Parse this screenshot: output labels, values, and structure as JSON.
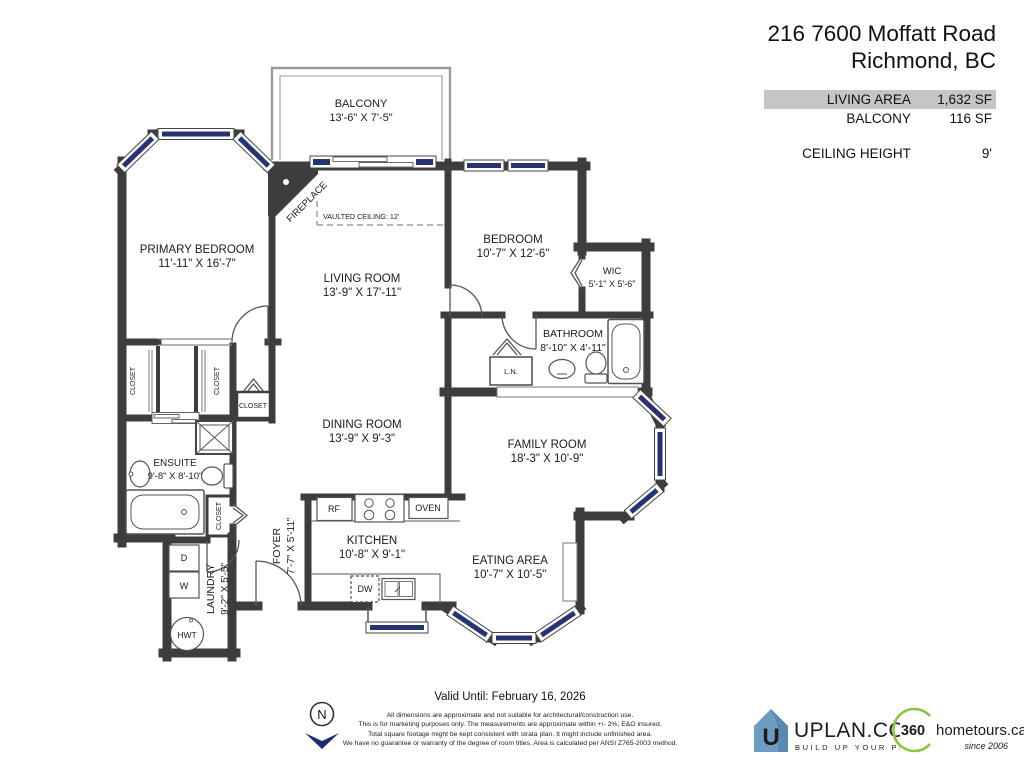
{
  "header": {
    "address_line1": "216 7600 Moffatt Road",
    "address_line2": "Richmond, BC",
    "stats": [
      {
        "label": "LIVING AREA",
        "value": "1,632 SF"
      },
      {
        "label": "BALCONY",
        "value": "116 SF"
      },
      {
        "label": "CEILING HEIGHT",
        "value": "9'"
      }
    ]
  },
  "plan": {
    "rooms": [
      {
        "name": "BALCONY",
        "dims": "13'-6\" X  7'-5\""
      },
      {
        "name": "PRIMARY BEDROOM",
        "dims": "11'-11\" X  16'-7\""
      },
      {
        "name": "LIVING ROOM",
        "dims": "13'-9\" X 17'-11\""
      },
      {
        "name": "BEDROOM",
        "dims": "10'-7\" X 12'-6\""
      },
      {
        "name": "WIC",
        "dims": "5'-1\" X 5'-6\""
      },
      {
        "name": "BATHROOM",
        "dims": "8'-10\" X 4'-11\""
      },
      {
        "name": "DINING ROOM",
        "dims": "13'-9\" X  9'-3\""
      },
      {
        "name": "FAMILY ROOM",
        "dims": "18'-3\" X 10'-9\""
      },
      {
        "name": "ENSUITE",
        "dims": "9'-8\" X 8'-10\""
      },
      {
        "name": "KITCHEN",
        "dims": "10'-8\" X  9'-1\""
      },
      {
        "name": "EATING AREA",
        "dims": "10'-7\" X 10'-5\""
      },
      {
        "name": "FOYER",
        "dims": "7'-7\" X 5'-11\""
      },
      {
        "name": "LAUNDRY",
        "dims": "9'-2\" X 5'-5\""
      }
    ],
    "labels": {
      "fireplace": "FIREPLACE",
      "vaulted": "VAULTED CEILING: 12'",
      "linen": "L.N.",
      "closet": "CLOSET"
    },
    "appliances": {
      "rf": "RF",
      "oven": "OVEN",
      "dw": "DW",
      "dryer": "D",
      "washer": "W",
      "hwt": "HWT"
    },
    "north_label": "N"
  },
  "footer": {
    "valid_until": "Valid Until: February 16, 2026",
    "disclaimer": [
      "All dimensions are approximate and not suitable for architectural/construction use.",
      "This is for marketing purposes only. The measurements are approximate within +/- 2%, E&O insured.",
      "Total square footage might be kept consistent with strata plan. It might include unfinished area.",
      "We have no guarantee or warranty of the degree of room titles. Area is calculated per ANSI Z765-2003 method."
    ],
    "uplan": {
      "icon_letter": "U",
      "name": "UPLAN.CO",
      "tagline": "BUILD UP YOUR PLAN"
    },
    "tours": {
      "number": "360",
      "name": "hometours.ca",
      "since": "since 2006"
    }
  },
  "colors": {
    "wall": "#3d3d3d",
    "window": "#273271",
    "highlight_row": "#c5c5c5",
    "uplan_blue": "#6d9cc3",
    "tours_green": "#8cc63f",
    "north_navy": "#1d2b6f"
  }
}
